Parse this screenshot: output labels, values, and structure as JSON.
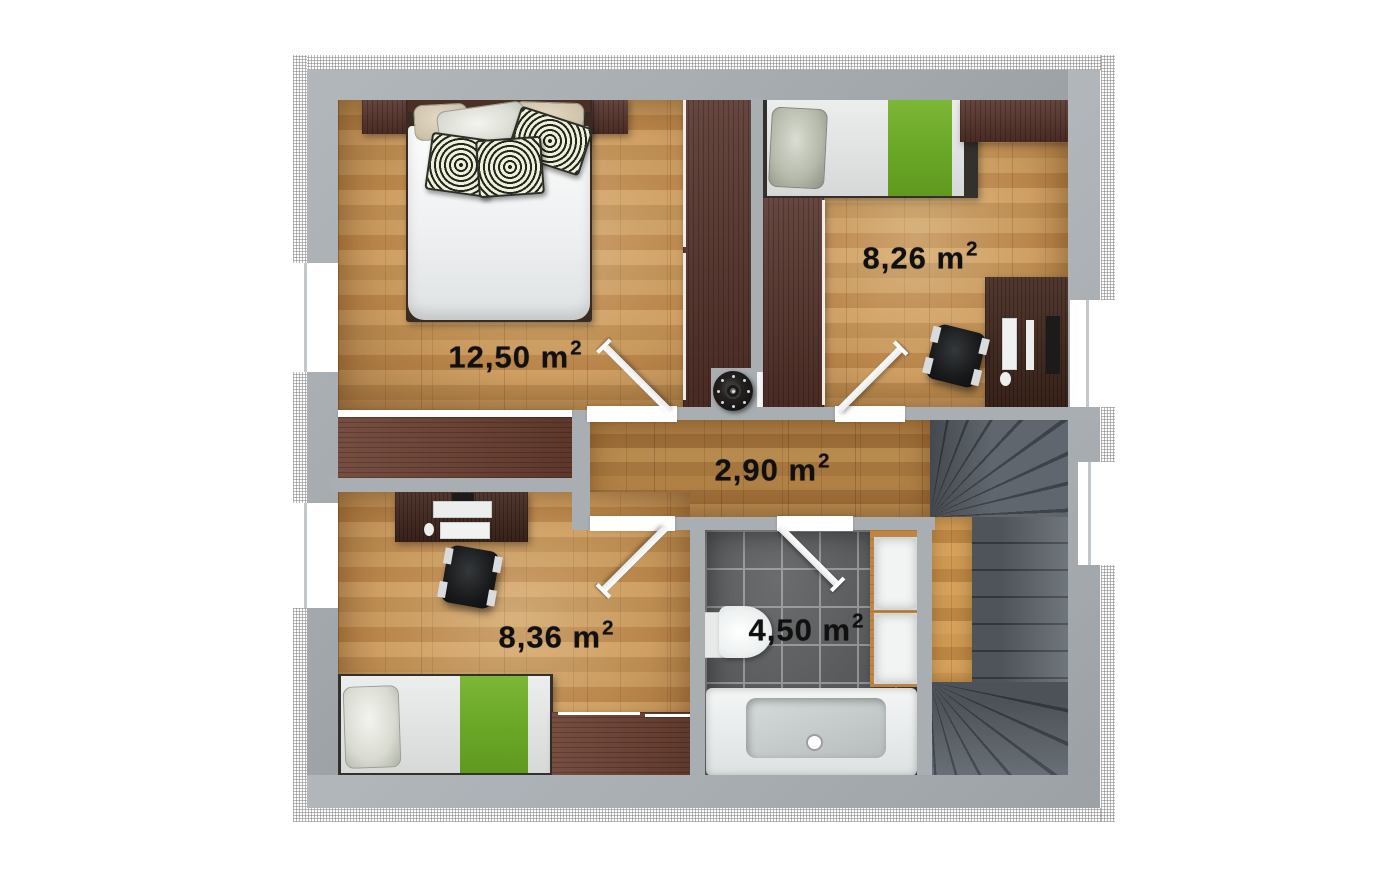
{
  "plan_title": "first-floor-plan",
  "rooms": {
    "master_bedroom": {
      "area": "12,50 m",
      "sup": "2"
    },
    "bedroom_top_right": {
      "area": "8,26 m",
      "sup": "2"
    },
    "hallway": {
      "area": "2,90 m",
      "sup": "2"
    },
    "bedroom_bottom_left": {
      "area": "8,36 m",
      "sup": "2"
    },
    "bathroom": {
      "area": "4,50 m",
      "sup": "2"
    }
  },
  "colors": {
    "wall": "#a8aeb2",
    "hatch_line": "#828282",
    "floor_wood": "#bf8f55",
    "floor_hallway": "#a87840",
    "floor_landing": "#c6934c",
    "bathroom_tile": "#56585a",
    "tile_grout": "#909293",
    "blanket_green": "#6aa626",
    "dark_furniture": "#55322a",
    "stair_tread": "#5f666d",
    "stair_line": "#3c4349",
    "label_text": "#101010"
  }
}
